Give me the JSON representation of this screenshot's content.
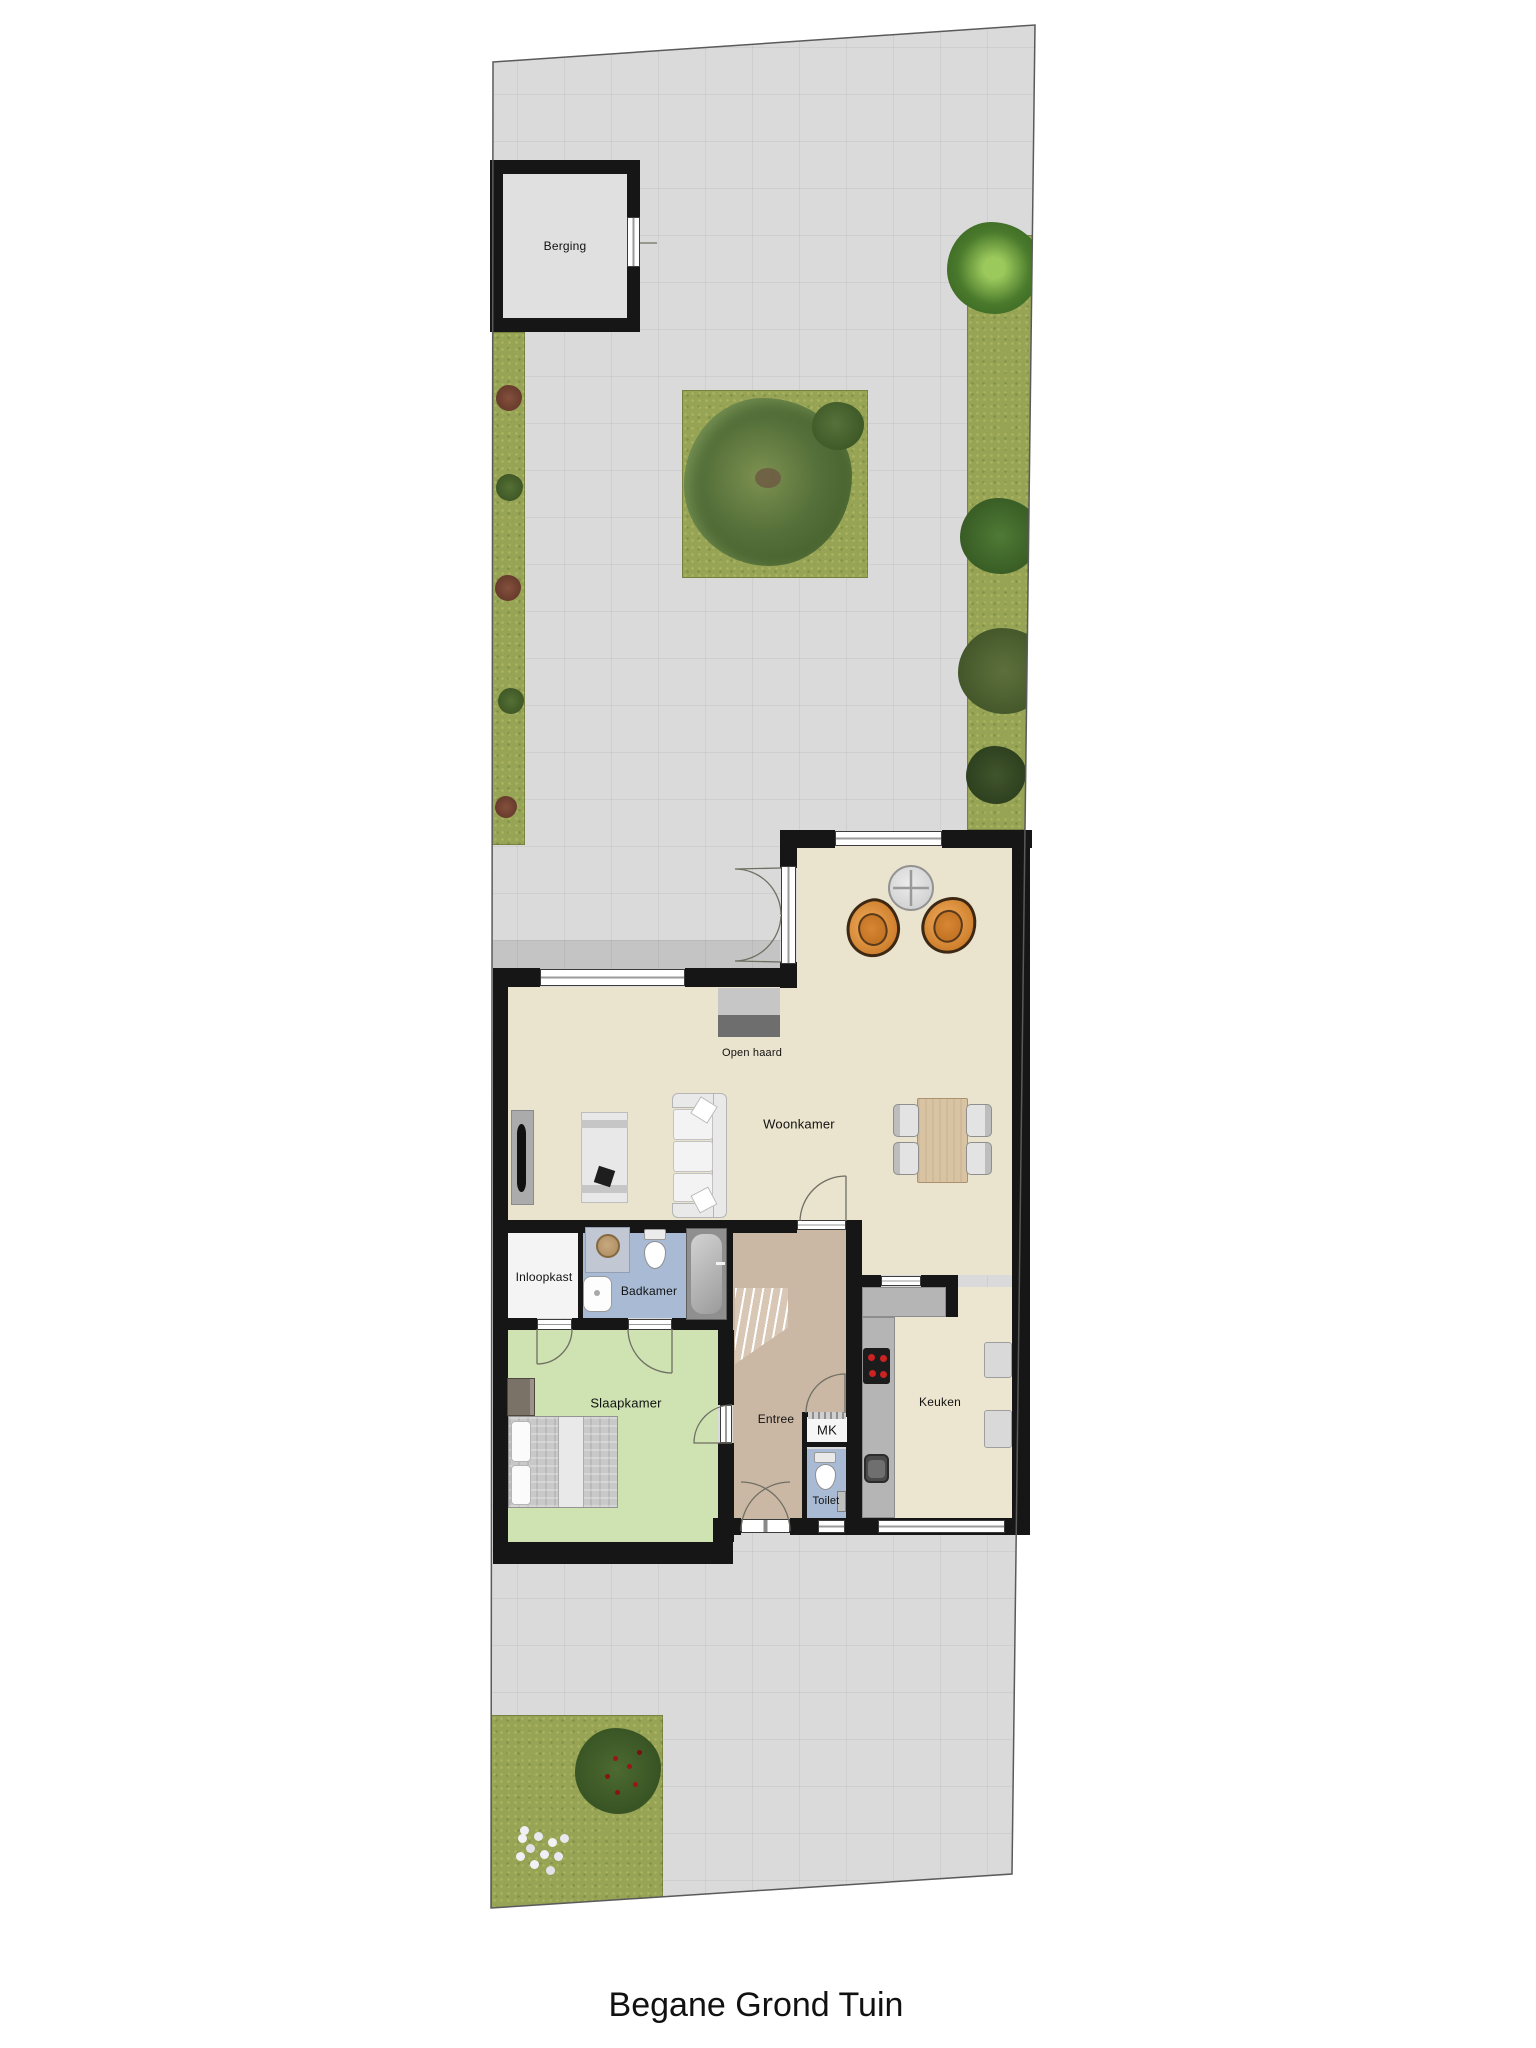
{
  "title": "Begane Grond Tuin",
  "labels": {
    "berging": "Berging",
    "open_haard": "Open haard",
    "woonkamer": "Woonkamer",
    "inloopkast": "Inloopkast",
    "badkamer": "Badkamer",
    "slaapkamer": "Slaapkamer",
    "entree": "Entree",
    "mk": "MK",
    "toilet": "Toilet",
    "keuken": "Keuken"
  },
  "colors": {
    "paving": "#dadada",
    "grass": "#97a455",
    "wall": "#161616",
    "living_floor": "#eae3cd",
    "entry_floor": "#cbb8a4",
    "bedroom_floor": "#cfe2b2",
    "bathroom_floor": "#a9bbd4",
    "closet_floor": "#f4f4f4",
    "shed_floor": "#e0e0e0",
    "counter": "#b5b5b5",
    "accent_chair": "#cd7d2a",
    "dining_table": "#d8c3a3"
  }
}
